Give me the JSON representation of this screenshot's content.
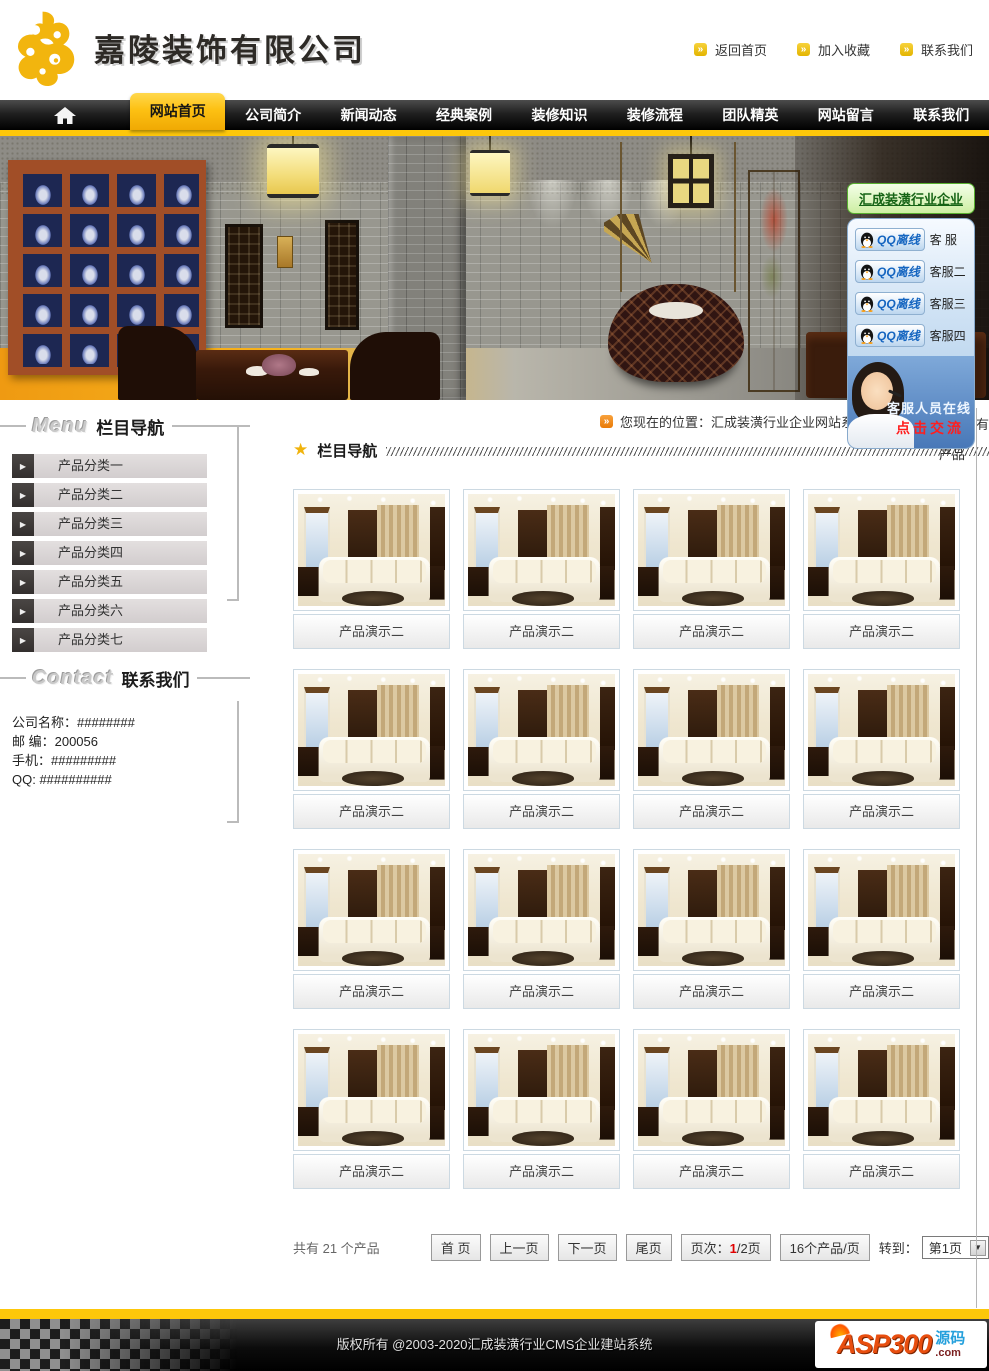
{
  "header": {
    "company_name": "嘉陵装饰有限公司",
    "top_links": [
      "返回首页",
      "加入收藏",
      "联系我们"
    ]
  },
  "nav": {
    "items": [
      "网站首页",
      "公司简介",
      "新闻动态",
      "经典案例",
      "装修知识",
      "装修流程",
      "团队精英",
      "网站留言",
      "联系我们"
    ],
    "active_index": 0
  },
  "qq_panel": {
    "title": "汇成装潢行业企业",
    "agents": [
      {
        "button": "QQ离线",
        "name": "客 服"
      },
      {
        "button": "QQ离线",
        "name": "客服二"
      },
      {
        "button": "QQ离线",
        "name": "客服三"
      },
      {
        "button": "QQ离线",
        "name": "客服四"
      }
    ],
    "online_text": "客服人员在线",
    "click_text": "点击交流"
  },
  "sidebar": {
    "menu_title_en": "Menu",
    "menu_title_cn": "栏目导航",
    "categories": [
      "产品分类一",
      "产品分类二",
      "产品分类三",
      "产品分类四",
      "产品分类五",
      "产品分类六",
      "产品分类七"
    ],
    "contact_title_en": "Contact",
    "contact_title_cn": "联系我们",
    "contact_lines": [
      "公司名称：########",
      "邮 编：200056",
      "手机：#########",
      "QQ: ##########"
    ]
  },
  "main": {
    "breadcrumb_prefix": "您现在的位置：汇成装潢行业企业网站系统",
    "breadcrumb_suffix": "有",
    "breadcrumb_line2": "产品",
    "section_title": "栏目导航",
    "products": [
      "产品演示二",
      "产品演示二",
      "产品演示二",
      "产品演示二",
      "产品演示二",
      "产品演示二",
      "产品演示二",
      "产品演示二",
      "产品演示二",
      "产品演示二",
      "产品演示二",
      "产品演示二",
      "产品演示二",
      "产品演示二",
      "产品演示二",
      "产品演示二"
    ],
    "pagination": {
      "total_text": "共有 21 个产品",
      "first": "首 页",
      "prev": "上一页",
      "next": "下一页",
      "last": "尾页",
      "page_label": "页次：",
      "page_current": "1",
      "page_rest": "/2页",
      "per_page": "16个产品/页",
      "goto_label": "转到：",
      "goto_value": "第1页"
    }
  },
  "footer": {
    "copyright": "版权所有 @2003-2020汇成装潢行业CMS企业建站系统",
    "logo_brand": "ASP300",
    "logo_cn": "源码",
    "logo_domain": ".com"
  },
  "colors": {
    "accent_yellow": "#fdc70a",
    "nav_black": "#141414",
    "active_tab_yellow": "#fdc113",
    "highlight_red": "#e00000",
    "qq_blue": "#1565c0",
    "panel_green": "#58b030",
    "sidebar_gray": "#d2cdce"
  }
}
